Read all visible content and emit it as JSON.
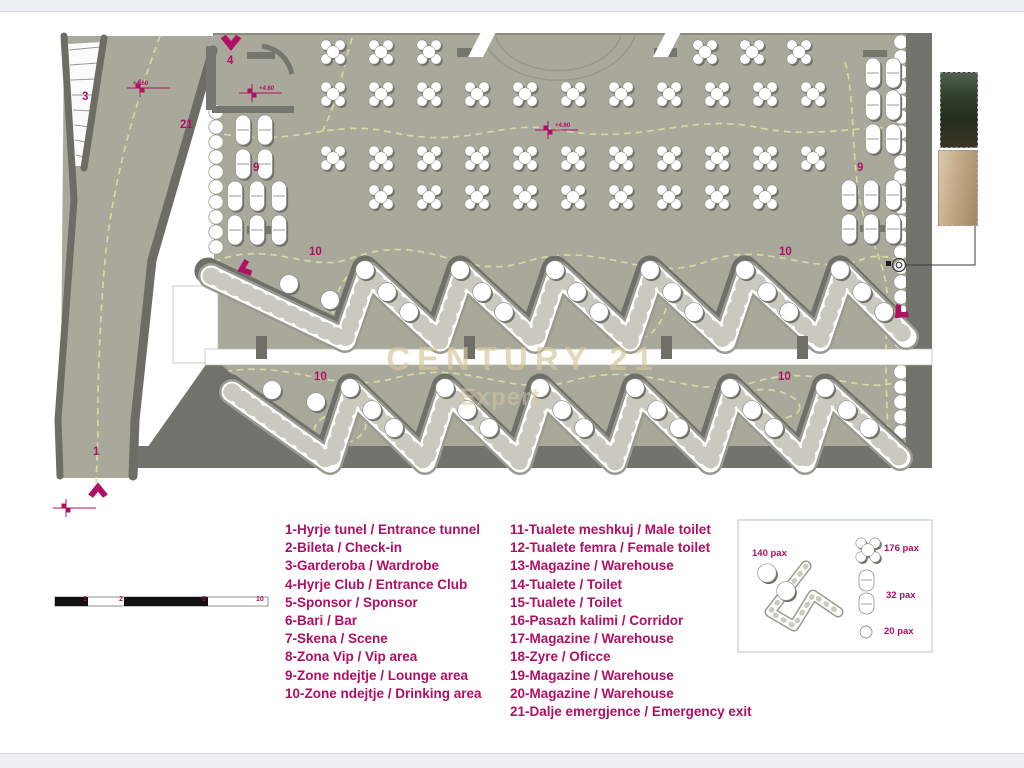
{
  "watermark": {
    "line1": "CENTURY 21",
    "line2": "Expert"
  },
  "plan": {
    "zone_labels": [
      "3",
      "21",
      "4",
      "9",
      "9",
      "10",
      "10",
      "10",
      "10",
      "1"
    ],
    "elevation_markers": [
      "+4.60",
      "+4.60",
      "+4.60"
    ],
    "scale_ticks": [
      "1",
      "2",
      "5",
      "10"
    ]
  },
  "legend": {
    "left": [
      "1-Hyrje tunel / Entrance tunnel",
      "2-Bileta / Check-in",
      "3-Garderoba / Wardrobe",
      "4-Hyrje Club / Entrance Club",
      "5-Sponsor / Sponsor",
      "6-Bari / Bar",
      "7-Skena / Scene",
      "8-Zona Vip / Vip area",
      "9-Zone ndejtje / Lounge area",
      "10-Zone ndejtje / Drinking area"
    ],
    "right": [
      "11-Tualete meshkuj / Male toilet",
      "12-Tualete femra / Female toilet",
      "13-Magazine / Warehouse",
      "14-Tualete / Toilet",
      "15-Tualete / Toilet",
      "16-Pasazh kalimi / Corridor",
      "17-Magazine / Warehouse",
      "18-Zyre / Oficce",
      "19-Magazine / Warehouse",
      "20-Magazine / Warehouse",
      "21-Dalje emergjence / Emergency exit"
    ]
  },
  "capacity_box": {
    "items": [
      "140 pax",
      "176 pax",
      "32 pax",
      "20 pax"
    ]
  },
  "colors": {
    "accent_magenta": "#b10f63",
    "floor": "#a8a89b",
    "wall_dark": "#6f6f68",
    "dashed_path": "#d9dd9f",
    "watermark_tan": "#d6c69c"
  }
}
